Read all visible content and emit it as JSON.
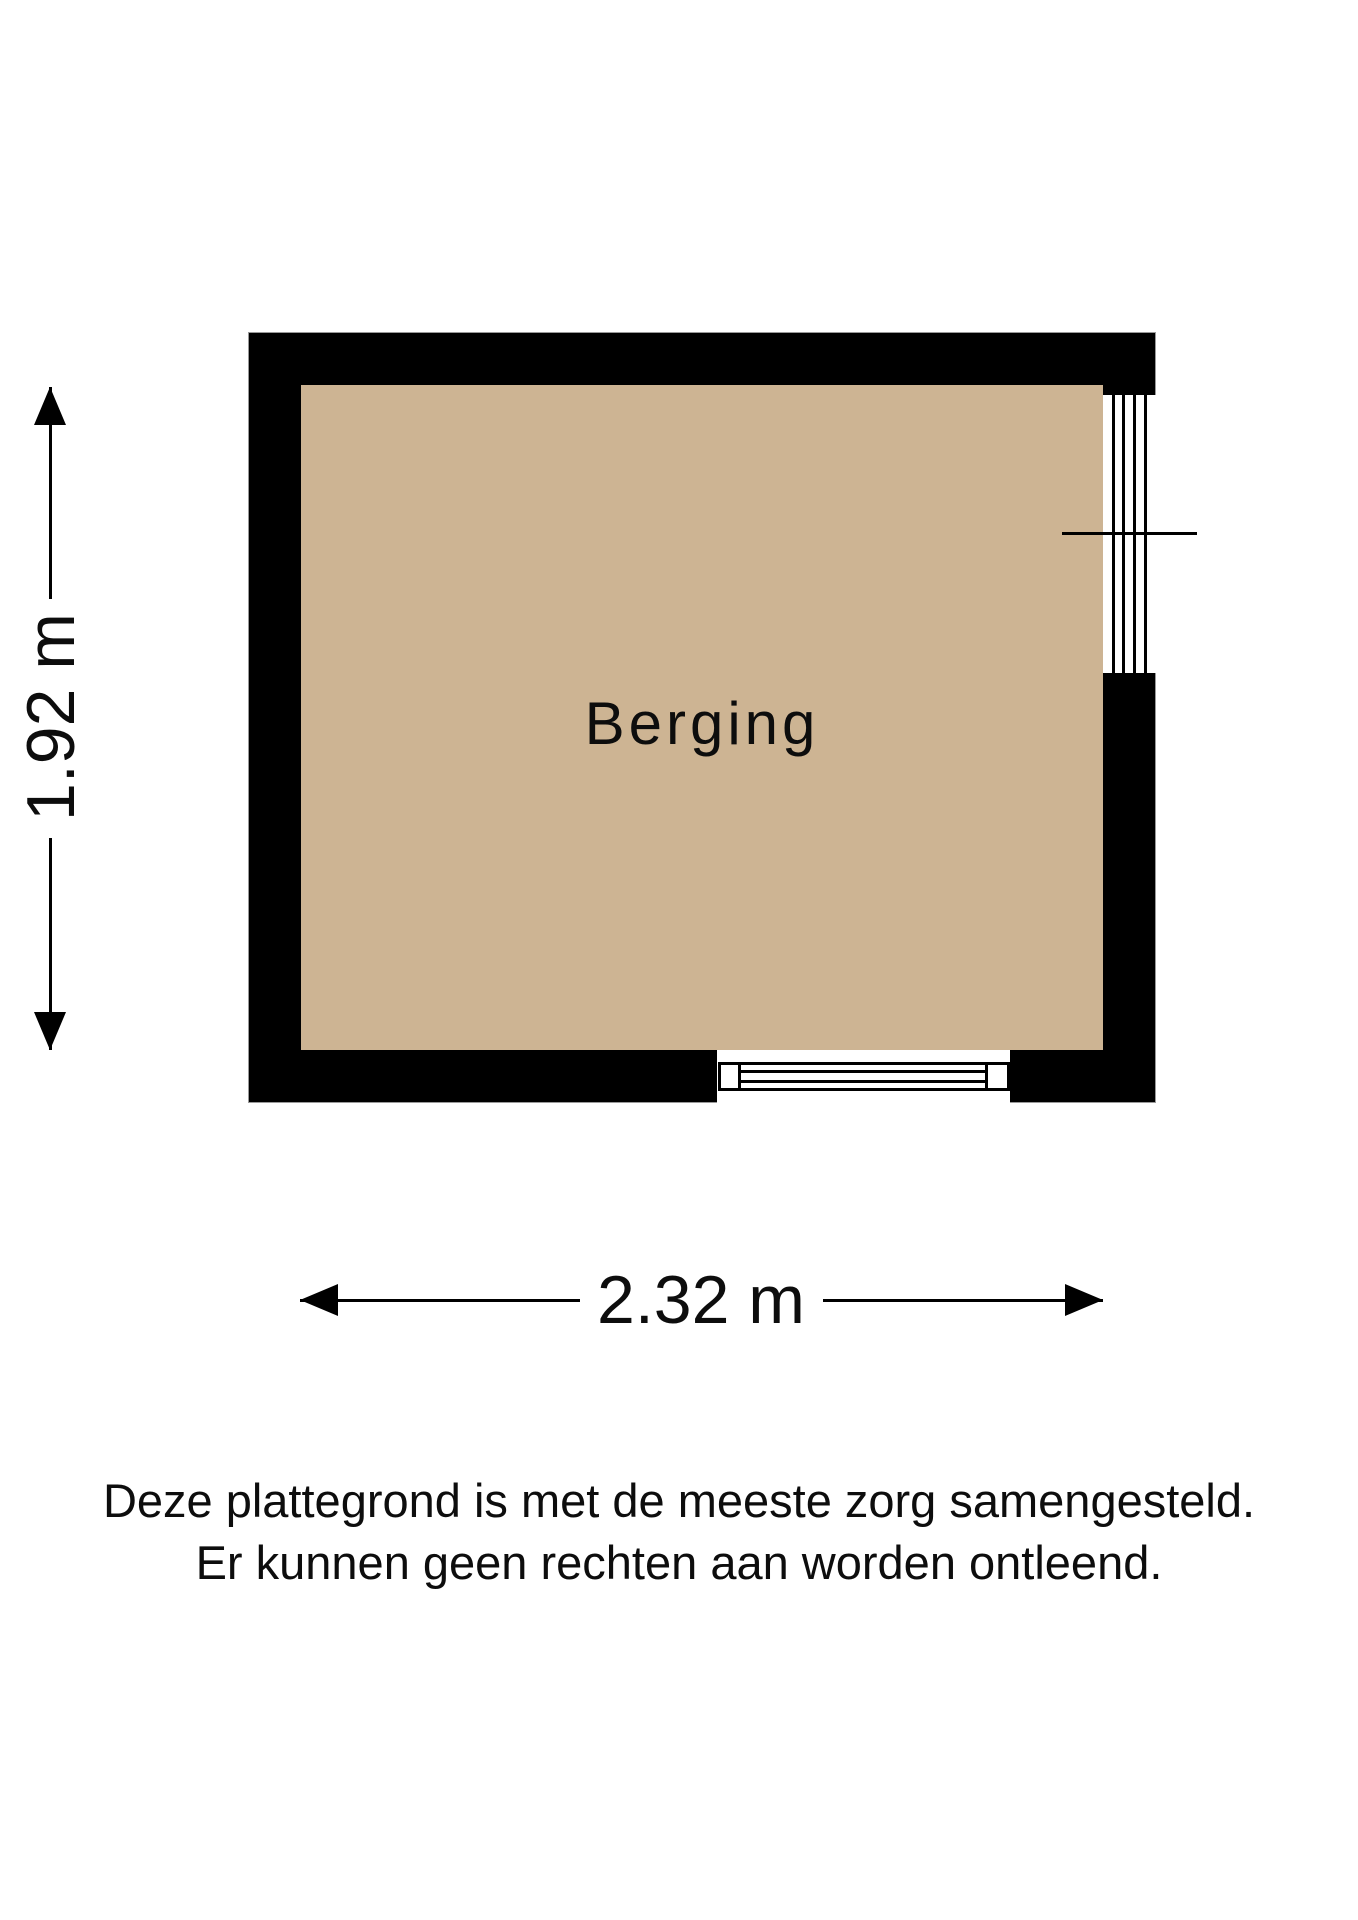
{
  "floorplan": {
    "room": {
      "label": "Berging"
    },
    "dimensions": {
      "height_label": "1.92 m",
      "width_label": "2.32 m"
    }
  },
  "disclaimer": {
    "line1": "Deze plattegrond is met de meeste zorg samengesteld.",
    "line2": "Er kunnen geen rechten aan worden ontleend."
  },
  "colors": {
    "floor_fill": "#CDB493",
    "wall": "#000000",
    "line": "#000000",
    "outline": "#999999"
  }
}
